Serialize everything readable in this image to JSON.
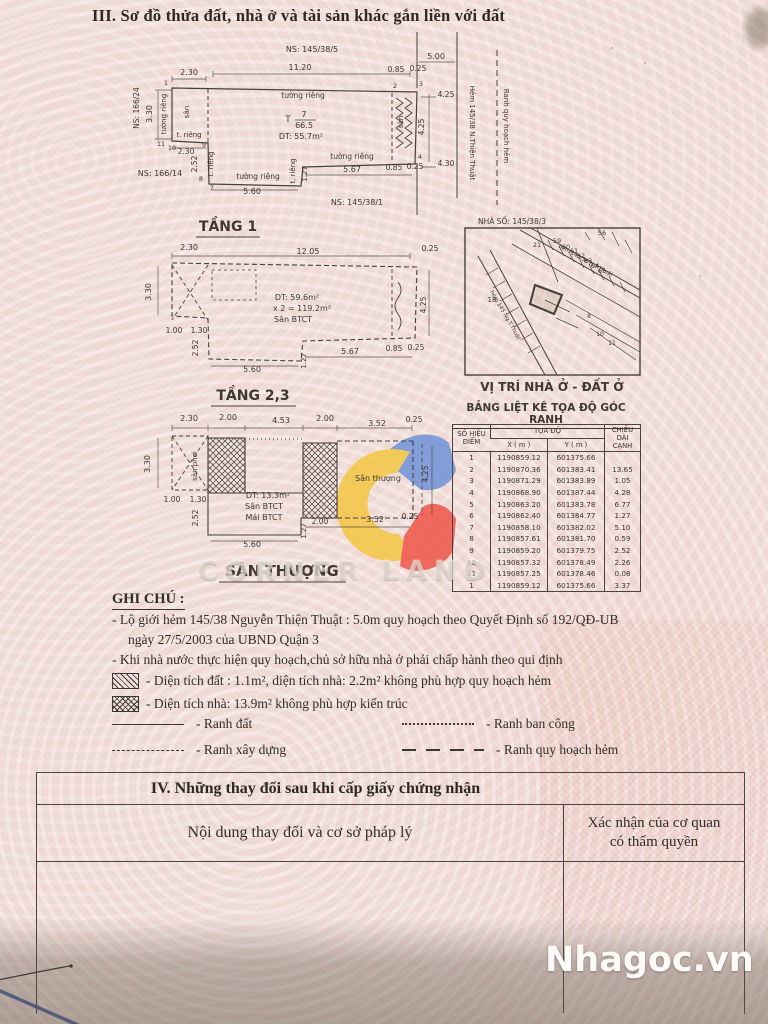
{
  "page": {
    "section3_title": "III. Sơ đồ thửa đất, nhà ở và tài sản khác gắn liền với đất"
  },
  "sec4": {
    "title": "IV. Những thay đổi sau khi cấp giấy chứng nhận",
    "col_left": "Nội dung thay đổi và cơ sở pháp lý",
    "col_right1": "Xác nhận của cơ quan",
    "col_right2": "có thẩm quyền"
  },
  "watermarks": {
    "brand": "CORNER LAND",
    "site": "Nhagoc.vn"
  },
  "colors": {
    "paper": "#efdcd7",
    "ink": "#47413b",
    "accent_blue": "#6a8fd8",
    "accent_yellow": "#f3c53d",
    "accent_red": "#ef4f43"
  },
  "ghi_chu": {
    "heading": "GHI CHÚ :",
    "line1": "- Lộ giới hẻm 145/38 Nguyễn Thiện Thuật : 5.0m quy hoạch theo Quyết Định số 192/QĐ-UB",
    "line1b": "ngày 27/5/2003 của UBND Quận 3",
    "line2": "- Khi nhà nước thực hiện quy hoạch,chủ sở hữu nhà ở phải chấp hành theo qui định",
    "line3": "- Diện tích đất : 1.1m², diện tích nhà: 2.2m² không phù hợp quy hoạch hẻm",
    "line4": "- Diện tích nhà: 13.9m² không phù hợp kiến trúc",
    "legend": [
      {
        "style": "solid",
        "label": "- Ranh đất"
      },
      {
        "style": "dotted",
        "label": "- Ranh ban công"
      },
      {
        "style": "dashed",
        "label": "- Ranh xây dựng"
      },
      {
        "style": "longdash",
        "label": "- Ranh quy hoạch hẻm"
      }
    ]
  },
  "coord_table": {
    "title": "BẢNG LIỆT KÊ TỌA ĐỘ GÓC RANH",
    "h_point1": "SỐ HIỆU",
    "h_point2": "ĐIỂM",
    "h_coord": "TỌA ĐỘ",
    "h_x": "X ( m )",
    "h_y": "Y ( m )",
    "h_len1": "CHIỀU DÀI",
    "h_len2": "CẠNH",
    "rows": [
      [
        "1",
        "1190859.12",
        "601375.66",
        ""
      ],
      [
        "2",
        "1190870.36",
        "601383.41",
        "13.65"
      ],
      [
        "3",
        "1190871.29",
        "601383.89",
        "1.05"
      ],
      [
        "4",
        "1190868.90",
        "601387.44",
        "4.28"
      ],
      [
        "5",
        "1190863.20",
        "601383.78",
        "6.77"
      ],
      [
        "6",
        "1190862.40",
        "601384.77",
        "1.27"
      ],
      [
        "7",
        "1190858.10",
        "601382.02",
        "5.10"
      ],
      [
        "8",
        "1190857.61",
        "601381.70",
        "0.59"
      ],
      [
        "9",
        "1190859.20",
        "601379.75",
        "2.52"
      ],
      [
        "10",
        "1190857.32",
        "601378.49",
        "2.26"
      ],
      [
        "11",
        "1190857.25",
        "601378.46",
        "0.08"
      ],
      [
        "1",
        "1190859.12",
        "601375.66",
        "3.37"
      ]
    ]
  },
  "drawing_labels": [
    {
      "t": "NS: 145/38/5",
      "x": 312,
      "y": 52,
      "s": 8
    },
    {
      "t": "5.00",
      "x": 436,
      "y": 59,
      "s": 8
    },
    {
      "t": "2.30",
      "x": 189,
      "y": 75,
      "s": 8
    },
    {
      "t": "11.20",
      "x": 300,
      "y": 70,
      "s": 8
    },
    {
      "t": "0.85",
      "x": 396,
      "y": 72,
      "s": 7.5
    },
    {
      "t": "0.25",
      "x": 418,
      "y": 71,
      "s": 7.5
    },
    {
      "t": "1",
      "x": 166,
      "y": 85,
      "s": 6.5
    },
    {
      "t": "2",
      "x": 395,
      "y": 88,
      "s": 6.5
    },
    {
      "t": "3",
      "x": 421,
      "y": 86,
      "s": 6.5
    },
    {
      "t": "NS: 166/24",
      "x": 139,
      "y": 108,
      "r": -90,
      "s": 7.5
    },
    {
      "t": "3.30",
      "x": 152,
      "y": 114,
      "r": -90,
      "s": 8
    },
    {
      "t": "tường riêng",
      "x": 166,
      "y": 114,
      "r": -90,
      "s": 7
    },
    {
      "t": "sân",
      "x": 189,
      "y": 112,
      "r": -90,
      "s": 7
    },
    {
      "t": "tường riêng",
      "x": 303,
      "y": 98,
      "s": 7.5
    },
    {
      "t": "T",
      "x": 288,
      "y": 122,
      "s": 8.5
    },
    {
      "t": "7",
      "x": 304,
      "y": 117,
      "s": 8
    },
    {
      "t": "66.5",
      "x": 304,
      "y": 128,
      "s": 8
    },
    {
      "t": "DT: 55.7m²",
      "x": 301,
      "y": 139,
      "s": 8
    },
    {
      "t": "sân",
      "x": 403,
      "y": 122,
      "r": -90,
      "s": 7
    },
    {
      "t": "4.25",
      "x": 424,
      "y": 127,
      "r": -90,
      "s": 7.5
    },
    {
      "t": "Hẻm  145/38 N.Thiện  Thuật",
      "x": 470,
      "y": 133,
      "r": 90,
      "s": 7
    },
    {
      "t": "Ranh quy hoạch hẻm",
      "x": 504,
      "y": 126,
      "r": 90,
      "s": 7
    },
    {
      "t": "4.25",
      "x": 446,
      "y": 97,
      "s": 7.5
    },
    {
      "t": "4.30",
      "x": 446,
      "y": 166,
      "s": 7.5
    },
    {
      "t": "t. riêng",
      "x": 189,
      "y": 137,
      "s": 7
    },
    {
      "t": "11",
      "x": 161,
      "y": 146,
      "s": 6.5
    },
    {
      "t": "10",
      "x": 172,
      "y": 150,
      "s": 6.5
    },
    {
      "t": "9",
      "x": 204,
      "y": 147,
      "s": 6.5
    },
    {
      "t": "2.30",
      "x": 186,
      "y": 154,
      "s": 7.5
    },
    {
      "t": "2.52",
      "x": 197,
      "y": 164,
      "r": -90,
      "s": 7.5
    },
    {
      "t": "t. riêng",
      "x": 213,
      "y": 164,
      "r": -90,
      "s": 7
    },
    {
      "t": "NS: 166/14",
      "x": 160,
      "y": 176,
      "s": 8
    },
    {
      "t": "8",
      "x": 201,
      "y": 181,
      "s": 6.5
    },
    {
      "t": "7",
      "x": 212,
      "y": 190,
      "s": 6.5
    },
    {
      "t": "tường riêng",
      "x": 258,
      "y": 179,
      "s": 7.5
    },
    {
      "t": "5.60",
      "x": 252,
      "y": 194,
      "s": 8
    },
    {
      "t": "t. riêng",
      "x": 295,
      "y": 171,
      "r": -90,
      "s": 7
    },
    {
      "t": "1.27",
      "x": 307,
      "y": 174,
      "r": -90,
      "s": 7
    },
    {
      "t": "tường riêng",
      "x": 352,
      "y": 159,
      "s": 7.5
    },
    {
      "t": "5.67",
      "x": 352,
      "y": 172,
      "s": 8
    },
    {
      "t": "0.85",
      "x": 394,
      "y": 170,
      "s": 7.5
    },
    {
      "t": "0.25",
      "x": 415,
      "y": 169,
      "s": 7.5
    },
    {
      "t": "4",
      "x": 420,
      "y": 159,
      "s": 6.5
    },
    {
      "t": "NS: 145/38/1",
      "x": 357,
      "y": 205,
      "s": 8
    },
    {
      "t": "TẦNG 1",
      "x": 228,
      "y": 231,
      "s": 14,
      "b": 1
    },
    {
      "t": "2.30",
      "x": 189,
      "y": 250,
      "s": 8
    },
    {
      "t": "12.05",
      "x": 308,
      "y": 254,
      "s": 8
    },
    {
      "t": "0.25",
      "x": 430,
      "y": 251,
      "s": 7.5
    },
    {
      "t": "3.30",
      "x": 151,
      "y": 292,
      "r": -90,
      "s": 8
    },
    {
      "t": "DT: 59.6m²",
      "x": 297,
      "y": 300,
      "s": 8
    },
    {
      "t": "x 2 = 119.2m²",
      "x": 302,
      "y": 311,
      "s": 8
    },
    {
      "t": "Sân BTCT",
      "x": 293,
      "y": 322,
      "s": 8
    },
    {
      "t": "1.00",
      "x": 174,
      "y": 333,
      "s": 7.5
    },
    {
      "t": "1.30",
      "x": 199,
      "y": 333,
      "s": 7.5
    },
    {
      "t": "2.52",
      "x": 198,
      "y": 348,
      "r": -90,
      "s": 7.5
    },
    {
      "t": "5.60",
      "x": 252,
      "y": 372,
      "s": 8
    },
    {
      "t": "1.27",
      "x": 306,
      "y": 361,
      "r": -90,
      "s": 7
    },
    {
      "t": "5.67",
      "x": 350,
      "y": 354,
      "s": 8
    },
    {
      "t": "0.85",
      "x": 394,
      "y": 351,
      "s": 7.5
    },
    {
      "t": "0.25",
      "x": 416,
      "y": 350,
      "s": 7.5
    },
    {
      "t": "4.25",
      "x": 426,
      "y": 305,
      "r": -90,
      "s": 7.5
    },
    {
      "t": "TẦNG 2,3",
      "x": 253,
      "y": 400,
      "s": 14,
      "b": 1
    },
    {
      "t": "2.30",
      "x": 189,
      "y": 421,
      "s": 8
    },
    {
      "t": "2.00",
      "x": 228,
      "y": 420,
      "s": 8
    },
    {
      "t": "4.53",
      "x": 281,
      "y": 423,
      "s": 8
    },
    {
      "t": "2.00",
      "x": 325,
      "y": 421,
      "s": 8
    },
    {
      "t": "3.52",
      "x": 377,
      "y": 426,
      "s": 8
    },
    {
      "t": "0.25",
      "x": 414,
      "y": 422,
      "s": 7.5
    },
    {
      "t": "3.30",
      "x": 150,
      "y": 464,
      "r": -90,
      "s": 8
    },
    {
      "t": "sân phơi",
      "x": 197,
      "y": 466,
      "r": -90,
      "s": 7
    },
    {
      "t": "Sân thượng",
      "x": 378,
      "y": 481,
      "s": 8
    },
    {
      "t": "DT: 13.3m²",
      "x": 268,
      "y": 498,
      "s": 8
    },
    {
      "t": "Sân BTCT",
      "x": 264,
      "y": 509,
      "s": 8
    },
    {
      "t": "Mái BTCT",
      "x": 264,
      "y": 520,
      "s": 8
    },
    {
      "t": "1.00",
      "x": 172,
      "y": 502,
      "s": 7.5
    },
    {
      "t": "1.30",
      "x": 198,
      "y": 502,
      "s": 7.5
    },
    {
      "t": "2.52",
      "x": 198,
      "y": 518,
      "r": -90,
      "s": 7.5
    },
    {
      "t": "2.00",
      "x": 320,
      "y": 524,
      "s": 7.5
    },
    {
      "t": "3.52",
      "x": 375,
      "y": 522,
      "s": 8
    },
    {
      "t": "0.25",
      "x": 410,
      "y": 519,
      "s": 7.5
    },
    {
      "t": "5.60",
      "x": 252,
      "y": 547,
      "s": 8
    },
    {
      "t": "1.27",
      "x": 306,
      "y": 531,
      "r": -90,
      "s": 7
    },
    {
      "t": "4.25",
      "x": 428,
      "y": 474,
      "r": -90,
      "s": 7.5
    },
    {
      "t": "SÂN THƯỢNG",
      "x": 282,
      "y": 576,
      "s": 15,
      "b": 1
    },
    {
      "t": "NHÀ SỐ: 145/38/3",
      "x": 512,
      "y": 224,
      "s": 7.5
    },
    {
      "t": "56",
      "x": 602,
      "y": 235,
      "s": 6.5
    },
    {
      "t": "59",
      "x": 557,
      "y": 243,
      "s": 6.5
    },
    {
      "t": "60",
      "x": 566,
      "y": 249,
      "s": 6.5
    },
    {
      "t": "61",
      "x": 574,
      "y": 253,
      "s": 6.5
    },
    {
      "t": "62",
      "x": 581,
      "y": 258,
      "s": 6.5
    },
    {
      "t": "63",
      "x": 588,
      "y": 263,
      "s": 6.5
    },
    {
      "t": "64",
      "x": 595,
      "y": 268,
      "s": 6.5
    },
    {
      "t": "65",
      "x": 602,
      "y": 273,
      "s": 6.5
    },
    {
      "t": "21",
      "x": 537,
      "y": 247,
      "s": 6.5
    },
    {
      "t": "18",
      "x": 492,
      "y": 302,
      "s": 7
    },
    {
      "t": "8",
      "x": 589,
      "y": 318,
      "s": 6
    },
    {
      "t": "10",
      "x": 600,
      "y": 336,
      "s": 6
    },
    {
      "t": "11",
      "x": 612,
      "y": 345,
      "s": 6
    },
    {
      "t": "hẻm 145/38 N.T.Thuật",
      "x": 585,
      "y": 262,
      "r": 29,
      "s": 5.5
    },
    {
      "t": "hẻm 145 Ng.T.Thuật",
      "x": 504,
      "y": 316,
      "r": 60,
      "s": 5.5
    },
    {
      "t": "VỊ TRÍ NHÀ Ở - ĐẤT Ở",
      "x": 552,
      "y": 391,
      "s": 12,
      "b": 1
    }
  ]
}
